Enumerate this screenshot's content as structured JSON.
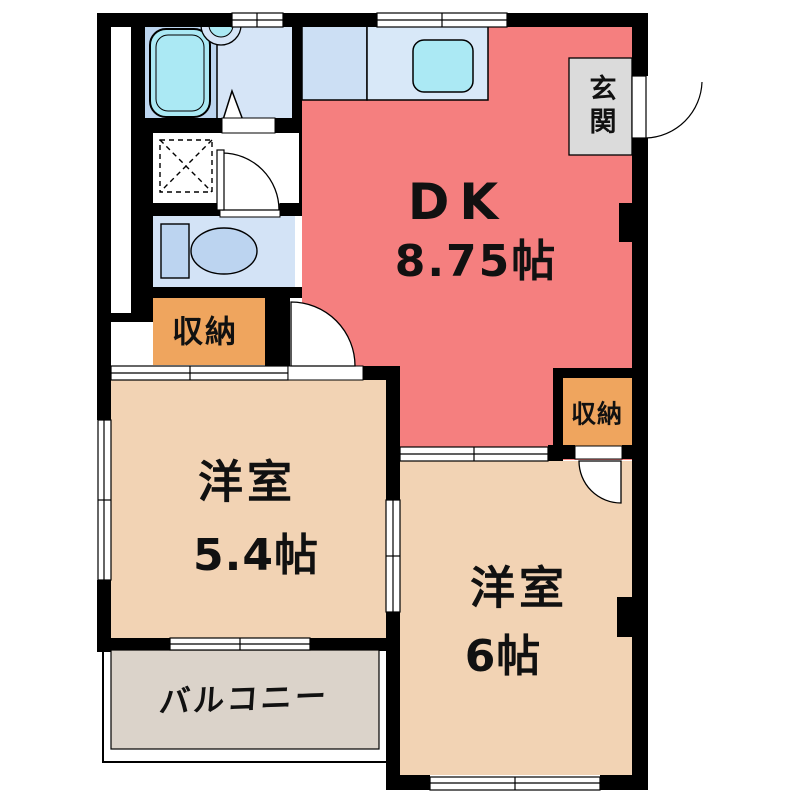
{
  "plan_title": "1DK apartment floor plan",
  "rooms": {
    "dk": {
      "label": "DK",
      "size": "8.75帖",
      "color": "#F57F7F"
    },
    "western_room_1": {
      "label": "洋室",
      "size": "5.4帖",
      "color": "#F2D3B4"
    },
    "western_room_2": {
      "label": "洋室",
      "size": "6帖",
      "color": "#F2D3B4"
    },
    "entrance": {
      "label": "玄関",
      "color": "#DBDBDB"
    },
    "closet_1": {
      "label": "収納",
      "color": "#EFA55E"
    },
    "closet_2": {
      "label": "収納",
      "color": "#EFA55E"
    },
    "balcony": {
      "label": "バルコニー",
      "color": "#DBD3CA"
    }
  },
  "fixtures": {
    "bathtub": "bathtub",
    "washbasin": "washbasin",
    "bathroom_folding_door": "folding-door",
    "washing_machine_space": "washing-machine-space",
    "toilet": "toilet",
    "kitchen_counter": "kitchen-counter",
    "kitchen_sink": "kitchen-sink",
    "hinged_doors": "door-swing",
    "sliding_windows": "sliding-window"
  },
  "colors": {
    "wall": "#000000",
    "background": "#FFFFFF",
    "text": "#111111",
    "bath_left": "#BCD5EF",
    "bath_right": "#D6E5F7",
    "counter_left": "#CCDFF4",
    "counter_right": "#D8E8F8",
    "water_cyan": "#ABE9F4",
    "toilet_room": "#D3E3F6",
    "fixture_blue": "#BCD4F0"
  }
}
